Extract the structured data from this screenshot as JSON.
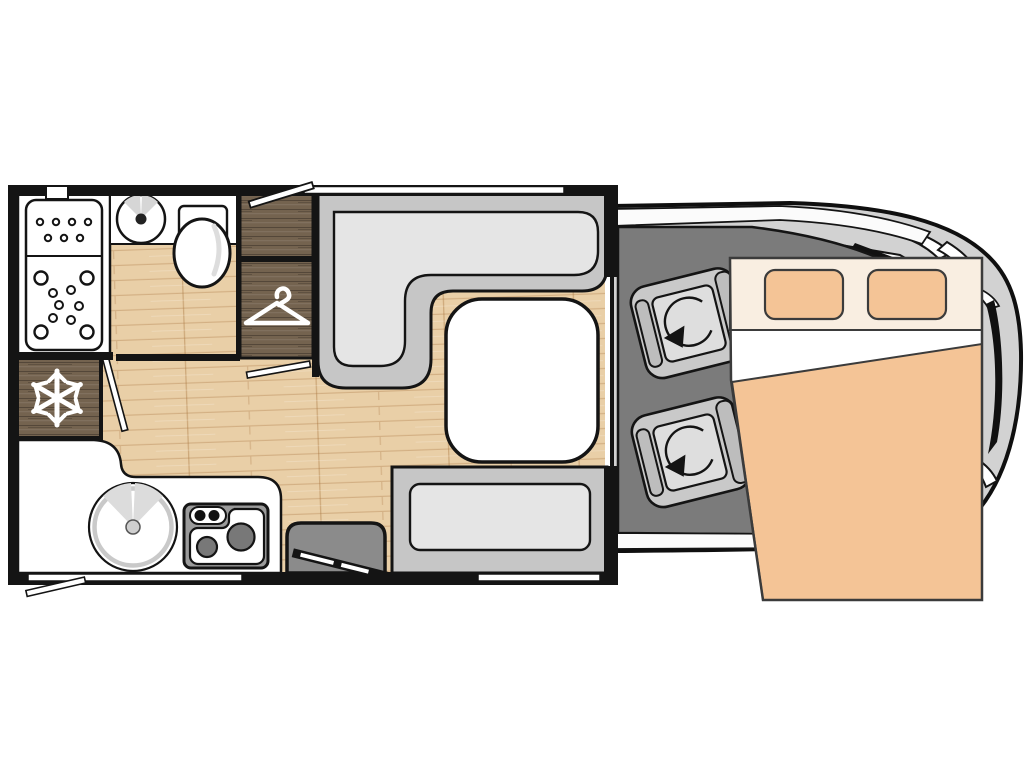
{
  "app": {
    "aria_label": "Motorhome floor plan - top view",
    "type": "floor-plan",
    "view": "top-down"
  },
  "palette": {
    "background": "#ffffff",
    "wall": "#141414",
    "wood_floor": "#e9cfa7",
    "wood_floor_joint": "#c9a87e",
    "dark_wood_furniture": "#74634f",
    "bench_frame": "#c6c6c6",
    "bench_cushion": "#e5e5e5",
    "table": "#ffffff",
    "cab_floor": "#7b7b7b",
    "vehicle_body": "#d2d2d2",
    "seat_frame": "#c9c9c9",
    "seat_cushion": "#dedede",
    "bed_fabric": "#f4c496",
    "bed_headboard": "#f9eee1",
    "bed_sheet": "#ffffff",
    "counter": "#ffffff",
    "stove_frame": "#9b9b9b",
    "burner": "#787878",
    "entry_mat": "#8b8b8b"
  },
  "icons": {
    "fridge": "snowflake-icon",
    "wardrobe": "hanger-icon",
    "cab_seats": "swivel-arrow-icon"
  },
  "areas": {
    "bathroom": {
      "fixtures": [
        "shower-tray",
        "washbasin",
        "toilet"
      ]
    },
    "wardrobe": {
      "sections": 2
    },
    "kitchen": {
      "fixtures": [
        "refrigerator",
        "round-sink",
        "two-burner-hob",
        "worktop"
      ]
    },
    "lounge": {
      "fixtures": [
        "l-shaped-bench",
        "pedestal-table",
        "side-bench"
      ]
    },
    "entrance": {
      "fixtures": [
        "entry-step-mat",
        "entry-door"
      ]
    },
    "cab": {
      "seats": [
        "passenger-swivel-seat",
        "driver-swivel-seat"
      ]
    },
    "bed": {
      "type": "drop-down-double-bed",
      "pillows": 2
    }
  },
  "openings": {
    "windows": [
      "lounge-top-window",
      "kitchen-bottom-window",
      "bench-bottom-window"
    ],
    "open_flaps": [
      "wardrobe-top-flap",
      "kitchen-bottom-flap"
    ],
    "doors": [
      "entry-door",
      "bathroom-sliding-door",
      "bedroom-partition-door"
    ]
  }
}
